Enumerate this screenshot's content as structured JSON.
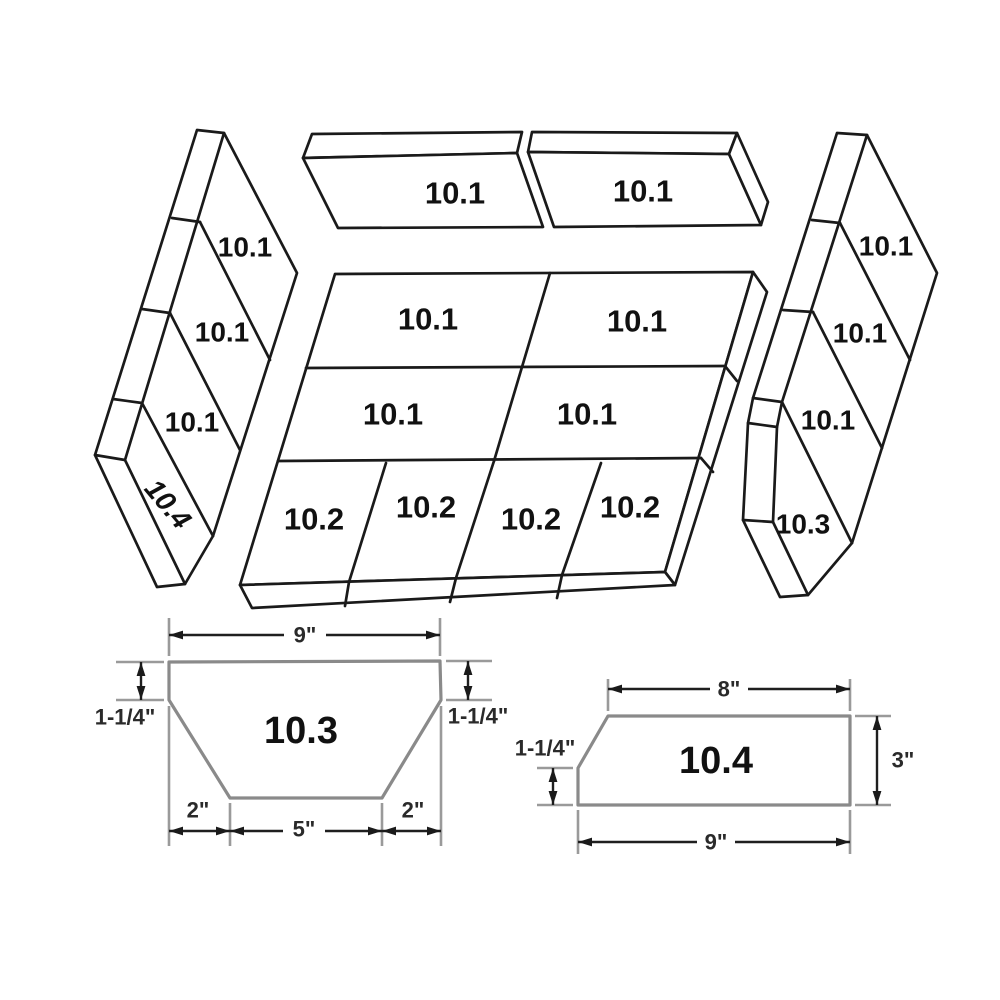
{
  "background": "#ffffff",
  "colors": {
    "panel_line": "#1a1a1a",
    "detail_shape_line": "#8a8a8a",
    "extension_line": "#9a9a9a",
    "dimension_line": "#1f1f1f",
    "text": "#111111"
  },
  "exploded_view": {
    "top_bricks": [
      "10.1",
      "10.1"
    ],
    "left_panel": [
      "10.1",
      "10.1",
      "10.1",
      "10.4"
    ],
    "center_panel": {
      "row1": [
        "10.1",
        "10.1"
      ],
      "row2": [
        "10.1",
        "10.1"
      ],
      "row3": [
        "10.2",
        "10.2",
        "10.2",
        "10.2"
      ]
    },
    "right_panel": [
      "10.1",
      "10.1",
      "10.1",
      "10.3"
    ]
  },
  "detail_10_3": {
    "label": "10.3",
    "dim_top": "9\"",
    "dim_left": "1-1/4\"",
    "dim_right": "1-1/4\"",
    "dim_bottom_left": "2\"",
    "dim_bottom_center": "5\"",
    "dim_bottom_right": "2\""
  },
  "detail_10_4": {
    "label": "10.4",
    "dim_top": "8\"",
    "dim_right": "3\"",
    "dim_bottom": "9\"",
    "dim_left": "1-1/4\""
  }
}
